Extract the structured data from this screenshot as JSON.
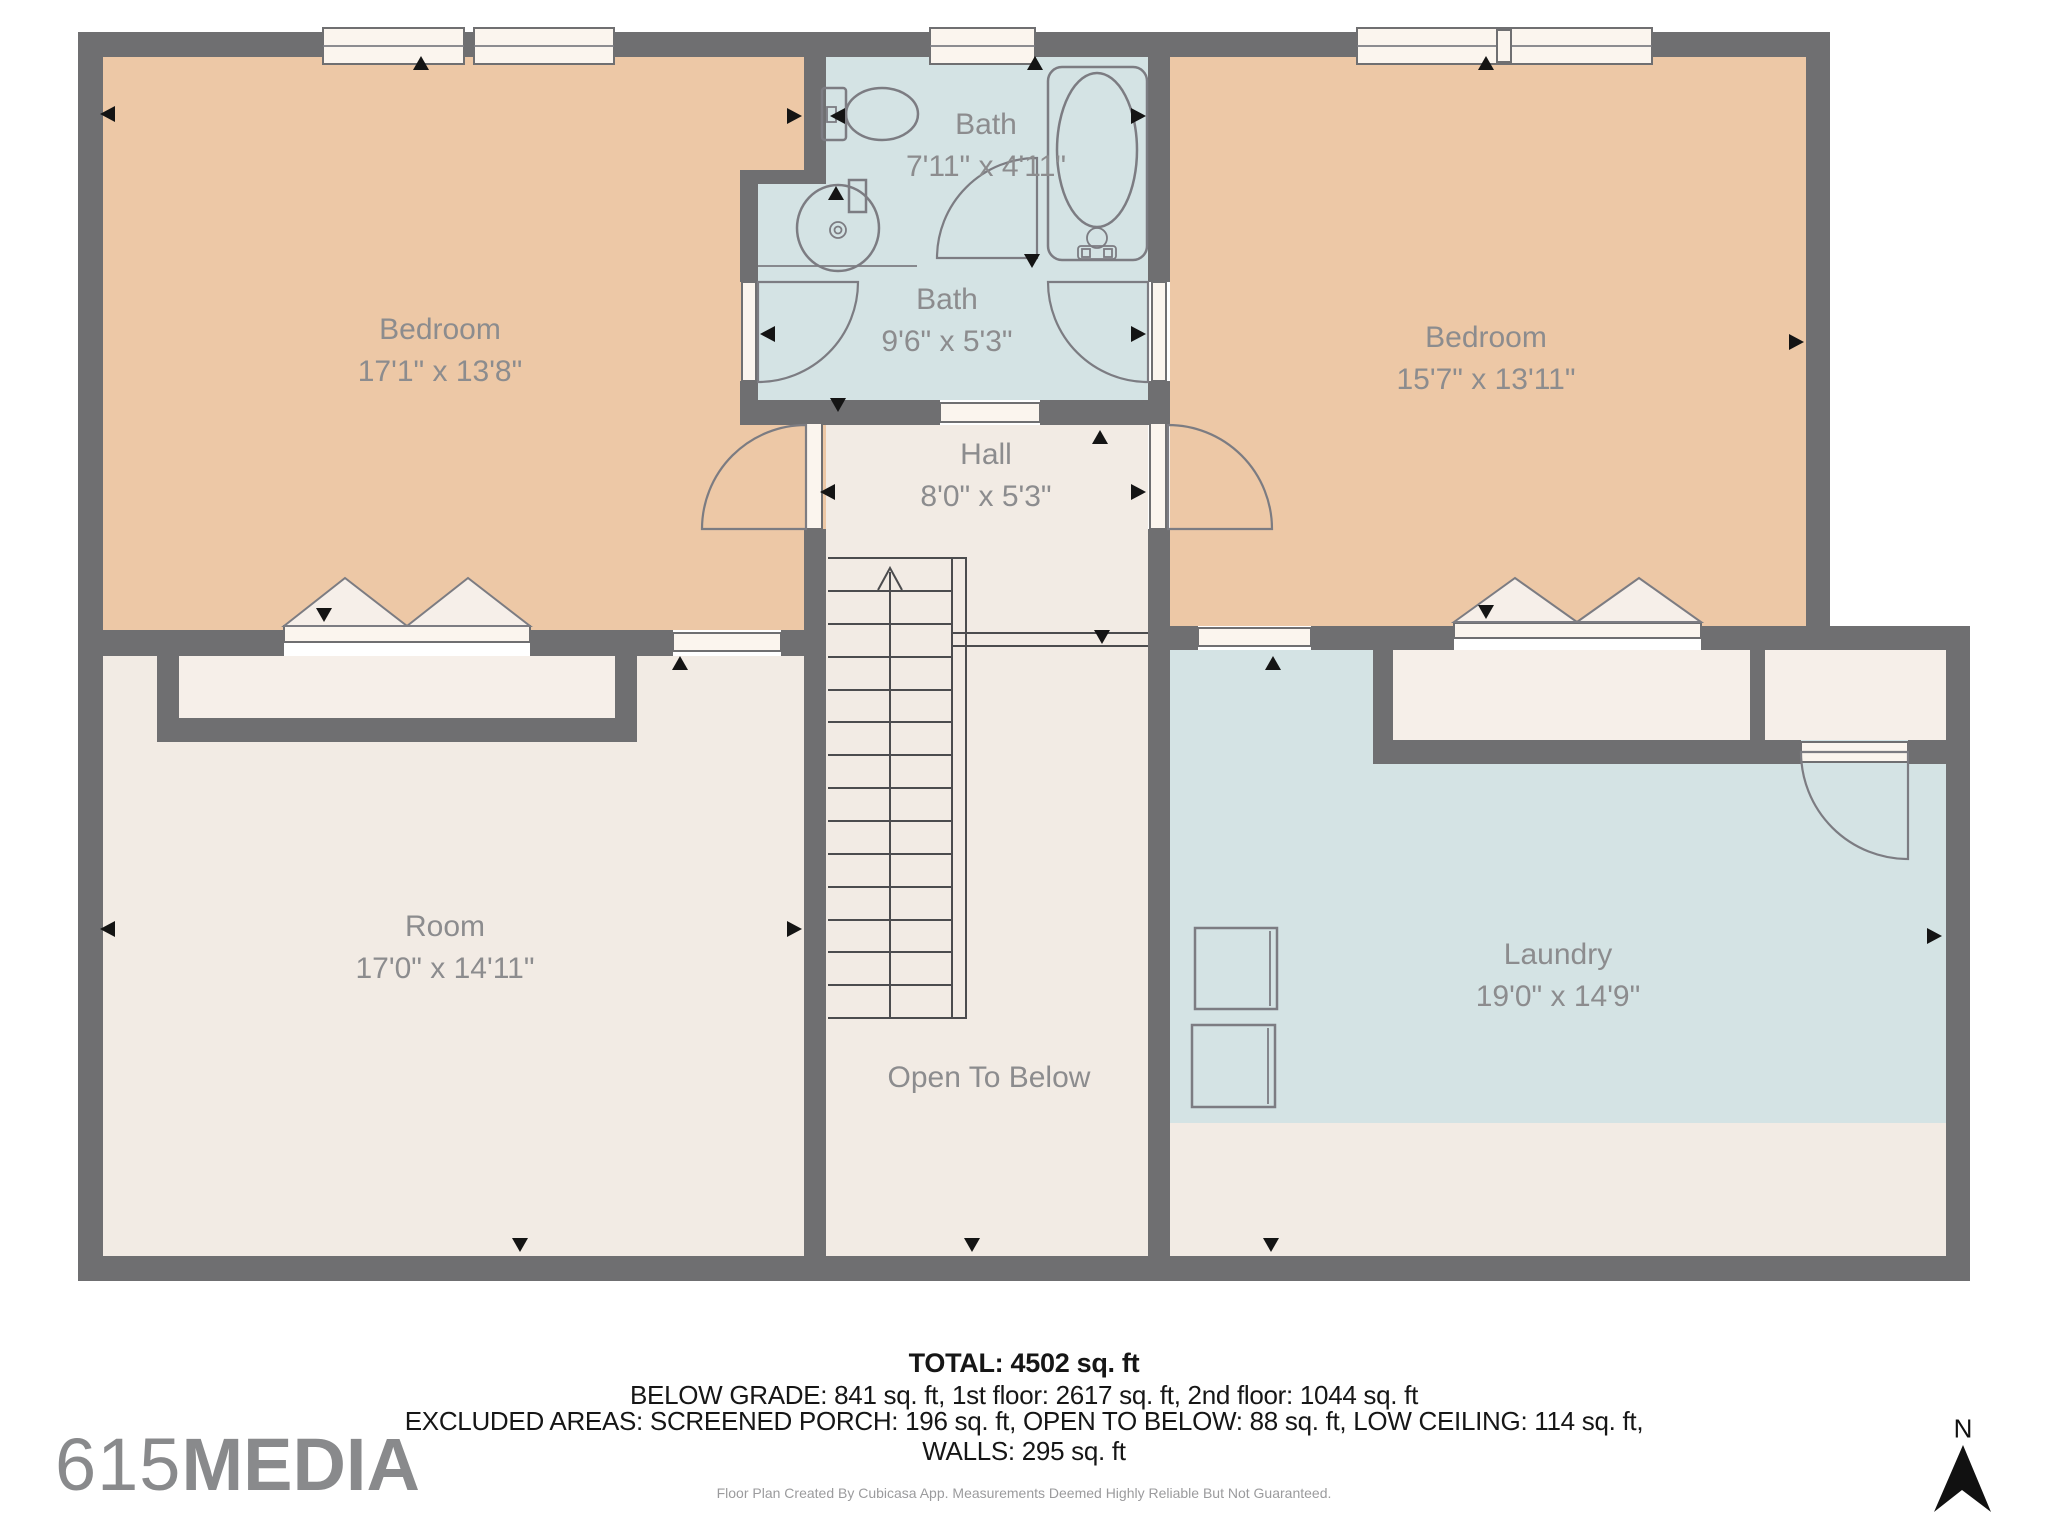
{
  "plan": {
    "colors": {
      "wall": "#6f6f71",
      "peach": "#edc8a6",
      "blue": "#d4e3e4",
      "cream": "#f2ebe4",
      "cream_light": "#f6efe9",
      "sill": "#fbf5ee",
      "label": "#8c8c8e",
      "fixture": "#7c7c82",
      "stair": "#4c4c4e",
      "arrow": "#141414"
    },
    "rooms": {
      "bedroom_left": {
        "name": "Bedroom",
        "dims": "17'1\" x 13'8\""
      },
      "bath_top": {
        "name": "Bath",
        "dims": "7'11\" x 4'11\""
      },
      "bath_middle": {
        "name": "Bath",
        "dims": "9'6\" x 5'3\""
      },
      "bedroom_right": {
        "name": "Bedroom",
        "dims": "15'7\" x 13'11\""
      },
      "hall": {
        "name": "Hall",
        "dims": "8'0\" x 5'3\""
      },
      "room": {
        "name": "Room",
        "dims": "17'0\" x 14'11\""
      },
      "open_to_below": {
        "name": "Open To Below"
      },
      "laundry": {
        "name": "Laundry",
        "dims": "19'0\" x 14'9\""
      }
    },
    "icons": [
      "toilet-icon",
      "sink-icon",
      "bathtub-icon",
      "washer-icon",
      "dryer-icon",
      "stairs-icon",
      "north-arrow-icon",
      "door-swing-icon",
      "bifold-door-icon",
      "window-icon"
    ]
  },
  "summary": {
    "total": "TOTAL: 4502 sq. ft",
    "line2": "BELOW GRADE: 841 sq. ft, 1st floor: 2617 sq. ft, 2nd floor: 1044 sq. ft",
    "line3": "EXCLUDED AREAS: SCREENED PORCH: 196 sq. ft, OPEN TO BELOW: 88 sq. ft, LOW CEILING: 114 sq. ft,",
    "line4": "WALLS: 295 sq. ft"
  },
  "branding": {
    "prefix": "615",
    "name": "MEDIA"
  },
  "compass": {
    "label": "N"
  },
  "footer": {
    "text": "Floor Plan Created By Cubicasa App. Measurements Deemed Highly Reliable But Not Guaranteed."
  }
}
